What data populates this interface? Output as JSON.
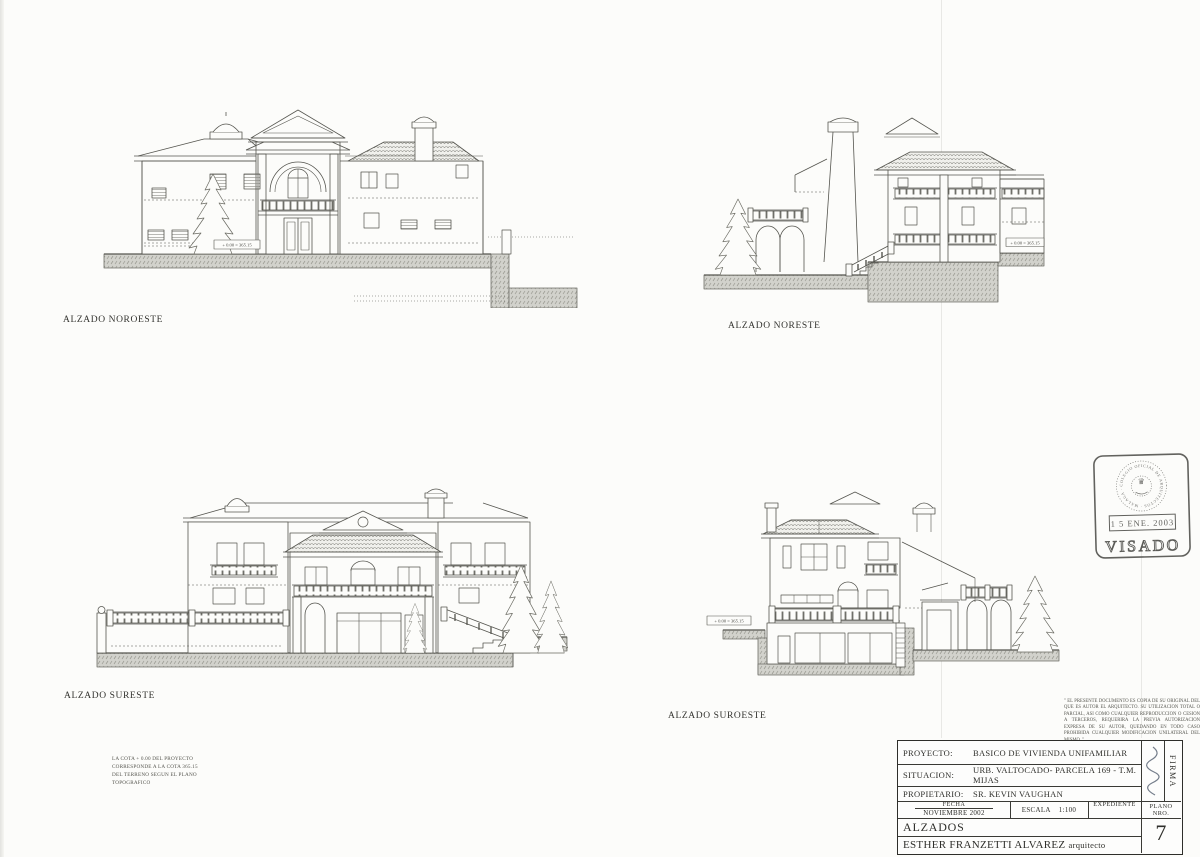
{
  "labels": {
    "noroeste": "ALZADO NOROESTE",
    "noreste": "ALZADO NORESTE",
    "sureste": "ALZADO SURESTE",
    "suroeste": "ALZADO SUROESTE"
  },
  "marker_text": "+ 0.00 = 365.15",
  "site_note": {
    "line1": "LA COTA + 0.00 DEL PROYECTO",
    "line2": "CORRESPONDE A LA COTA 365.15",
    "line3": "DEL TERRENO SEGUN EL PLANO",
    "line4": "TOPOGRAFICO"
  },
  "disclaimer": "\" EL PRESENTE DOCUMENTO ES COPIA DE SU ORIGINAL DEL QUE ES AUTOR EL ARQUITECTO. SU UTILIZACION TOTAL O PARCIAL, ASI COMO CUALQUIER REPRODUCCION O CESION A TERCEROS, REQUERIRA LA PREVIA AUTORIZACION EXPRESA DE SU AUTOR, QUEDANDO EN TODO CASO PROHIBIDA CUALQUIER MODIFICACION UNILATERAL DEL MISMO. \"",
  "stamp": {
    "ring_text": "COLEGIO OFICIAL DE ARQUITECTOS · MALAGA ·",
    "date": "1 5 ENE. 2003",
    "visado": "VISADO"
  },
  "title_block": {
    "proyecto_label": "PROYECTO:",
    "proyecto_value": "BASICO DE VIVIENDA UNIFAMILIAR",
    "situacion_label": "SITUACION:",
    "situacion_value": "URB. VALTOCADO- PARCELA 169 - T.M. MIJAS",
    "propietario_label": "PROPIETARIO:",
    "propietario_value": "SR. KEVIN VAUGHAN",
    "fecha_label": "FECHA",
    "fecha_value": "NOVIEMBRE 2002",
    "escala_label": "ESCALA",
    "escala_value": "1:100",
    "expediente_label": "EXPEDIENTE",
    "plano_nro_label": "PLANO NRO.",
    "sheet_name": "ALZADOS",
    "author": "ESTHER FRANZETTI ALVAREZ",
    "author_role": "arquitecto",
    "plano_number": "7",
    "firma_label": "FIRMA"
  }
}
